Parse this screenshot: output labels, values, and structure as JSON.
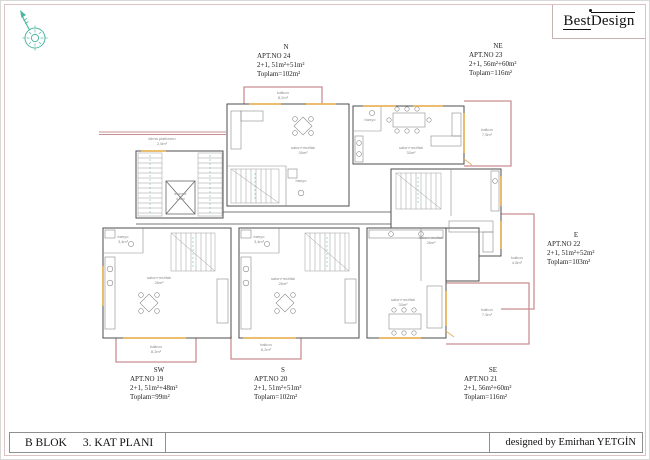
{
  "header": {
    "logo_best": "Best",
    "logo_design": "Design"
  },
  "apartments": [
    {
      "direction": "N",
      "apt_no": "APT.NO 24",
      "layout": "2+1, 51m²+51m²",
      "total": "Toplam=102m²"
    },
    {
      "direction": "NE",
      "apt_no": "APT.NO 23",
      "layout": "2+1, 56m²+60m²",
      "total": "Toplam=116m²"
    },
    {
      "direction": "E",
      "apt_no": "APT.NO 22",
      "layout": "2+1, 51m²+52m²",
      "total": "Toplam=103m²"
    },
    {
      "direction": "SE",
      "apt_no": "APT.NO 21",
      "layout": "2+1, 56m²+60m²",
      "total": "Toplam=116m²"
    },
    {
      "direction": "S",
      "apt_no": "APT.NO 20",
      "layout": "2+1, 51m²+51m²",
      "total": "Toplam=102m²"
    },
    {
      "direction": "SW",
      "apt_no": "APT.NO 19",
      "layout": "2+1, 51m²+48m²",
      "total": "Toplam=99m²"
    }
  ],
  "title_block": {
    "block_name": "B BLOK",
    "plan_name": "3. KAT PLANI",
    "credit": "designed by Emirhan YETGİN"
  },
  "plan": {
    "rooms": {
      "klima_platformu": "klima platformu",
      "klima_area": "2,5m²",
      "asansor": "asansör",
      "asansor_area": "4,0m²",
      "salon_mutfak": "salon+mutfak",
      "area_26": "26m²",
      "area_33": "33m²",
      "banyo": "banyo",
      "banyo_area": "3,4m²",
      "balkon": "balkon",
      "balkon_area_82": "8,2m²",
      "balkon_area_75": "7,5m²",
      "balkon_area_48": "4,8m²"
    }
  },
  "colors": {
    "balcony_pink": "#c98f93",
    "window_yellow": "#e9b45c",
    "compass_teal": "#4fb79f",
    "wall": "#4d4d4d"
  }
}
